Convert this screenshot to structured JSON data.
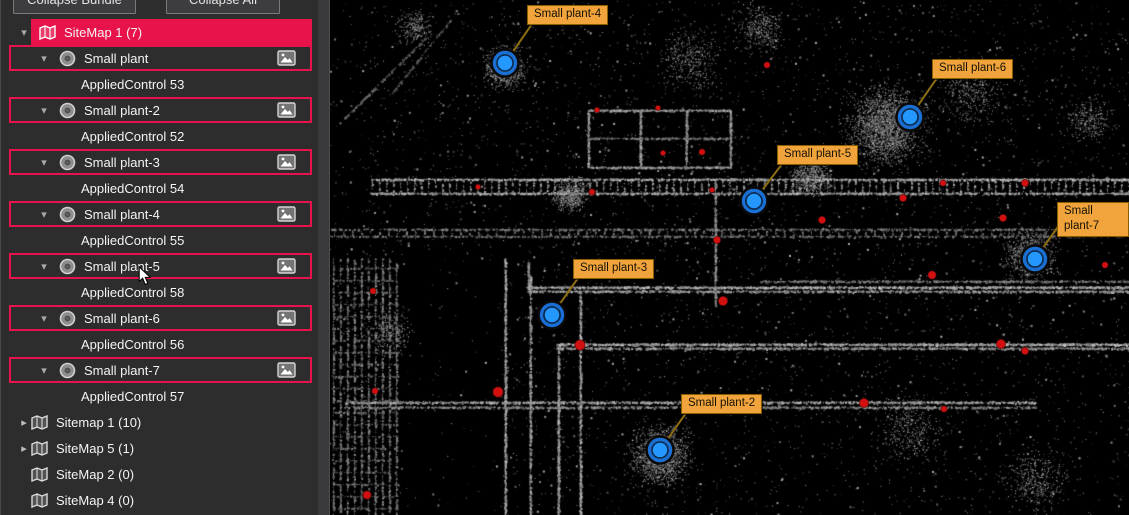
{
  "sidebar": {
    "buttons": [
      {
        "label": "Collapse Bundle"
      },
      {
        "label": "Collapse All"
      }
    ],
    "tree": {
      "selected_group": {
        "label": "SiteMap 1 (7)",
        "expanded": true,
        "children": [
          {
            "label": "Small plant",
            "control": "AppliedControl 53"
          },
          {
            "label": "Small plant-2",
            "control": "AppliedControl 52"
          },
          {
            "label": "Small plant-3",
            "control": "AppliedControl 54"
          },
          {
            "label": "Small plant-4",
            "control": "AppliedControl 55"
          },
          {
            "label": "Small plant-5",
            "control": "AppliedControl 58"
          },
          {
            "label": "Small plant-6",
            "control": "AppliedControl 56"
          },
          {
            "label": "Small plant-7",
            "control": "AppliedControl 57"
          }
        ]
      },
      "other_groups": [
        {
          "label": "Sitemap 1 (10)",
          "expandable": true
        },
        {
          "label": "SiteMap 5 (1)",
          "expandable": true
        },
        {
          "label": "SiteMap 2 (0)",
          "expandable": false
        },
        {
          "label": "SiteMap 4 (0)",
          "expandable": false
        }
      ]
    }
  },
  "viewer": {
    "markers": [
      {
        "name": "Small plant-4",
        "x": 175,
        "y": 63,
        "label_x": 197,
        "label_y": 5
      },
      {
        "name": "Small plant-6",
        "x": 580,
        "y": 117,
        "label_x": 602,
        "label_y": 59
      },
      {
        "name": "Small plant-5",
        "x": 424,
        "y": 201,
        "label_x": 447,
        "label_y": 145
      },
      {
        "name": "Small plant-7",
        "x": 705,
        "y": 259,
        "label_x": 727,
        "label_y": 202
      },
      {
        "name": "Small plant-3",
        "x": 222,
        "y": 315,
        "label_x": 243,
        "label_y": 259
      },
      {
        "name": "Small plant-2",
        "x": 330,
        "y": 450,
        "label_x": 351,
        "label_y": 394
      }
    ],
    "targets": [
      [
        437,
        65,
        3
      ],
      [
        267,
        110,
        2.5
      ],
      [
        328,
        108,
        2.5
      ],
      [
        333,
        153,
        2.5
      ],
      [
        372,
        152,
        3
      ],
      [
        148,
        187,
        2.5
      ],
      [
        262,
        192,
        3
      ],
      [
        382,
        190,
        2.5
      ],
      [
        387,
        240,
        3.5
      ],
      [
        613,
        183,
        3
      ],
      [
        695,
        183,
        3.5
      ],
      [
        573,
        198,
        3.5
      ],
      [
        492,
        220,
        3.5
      ],
      [
        673,
        218,
        3.5
      ],
      [
        43,
        291,
        3
      ],
      [
        393,
        301,
        4.5
      ],
      [
        250,
        345,
        5
      ],
      [
        168,
        392,
        5
      ],
      [
        45,
        391,
        3
      ],
      [
        37,
        495,
        4
      ],
      [
        602,
        275,
        4
      ],
      [
        671,
        344,
        4.5
      ],
      [
        695,
        351,
        3.5
      ],
      [
        534,
        403,
        4.5
      ],
      [
        614,
        409,
        3
      ],
      [
        775,
        265,
        3
      ]
    ]
  },
  "colors": {
    "accent_red": "#e8134a",
    "sidebar_bg": "#2d2d2d",
    "marker_fill": "#2598ff",
    "marker_ring": "#1a6fd4",
    "label_bg": "#f2a43c",
    "label_border": "#8a5c00",
    "leader": "#8c6d12",
    "target_red": "#d21010"
  }
}
